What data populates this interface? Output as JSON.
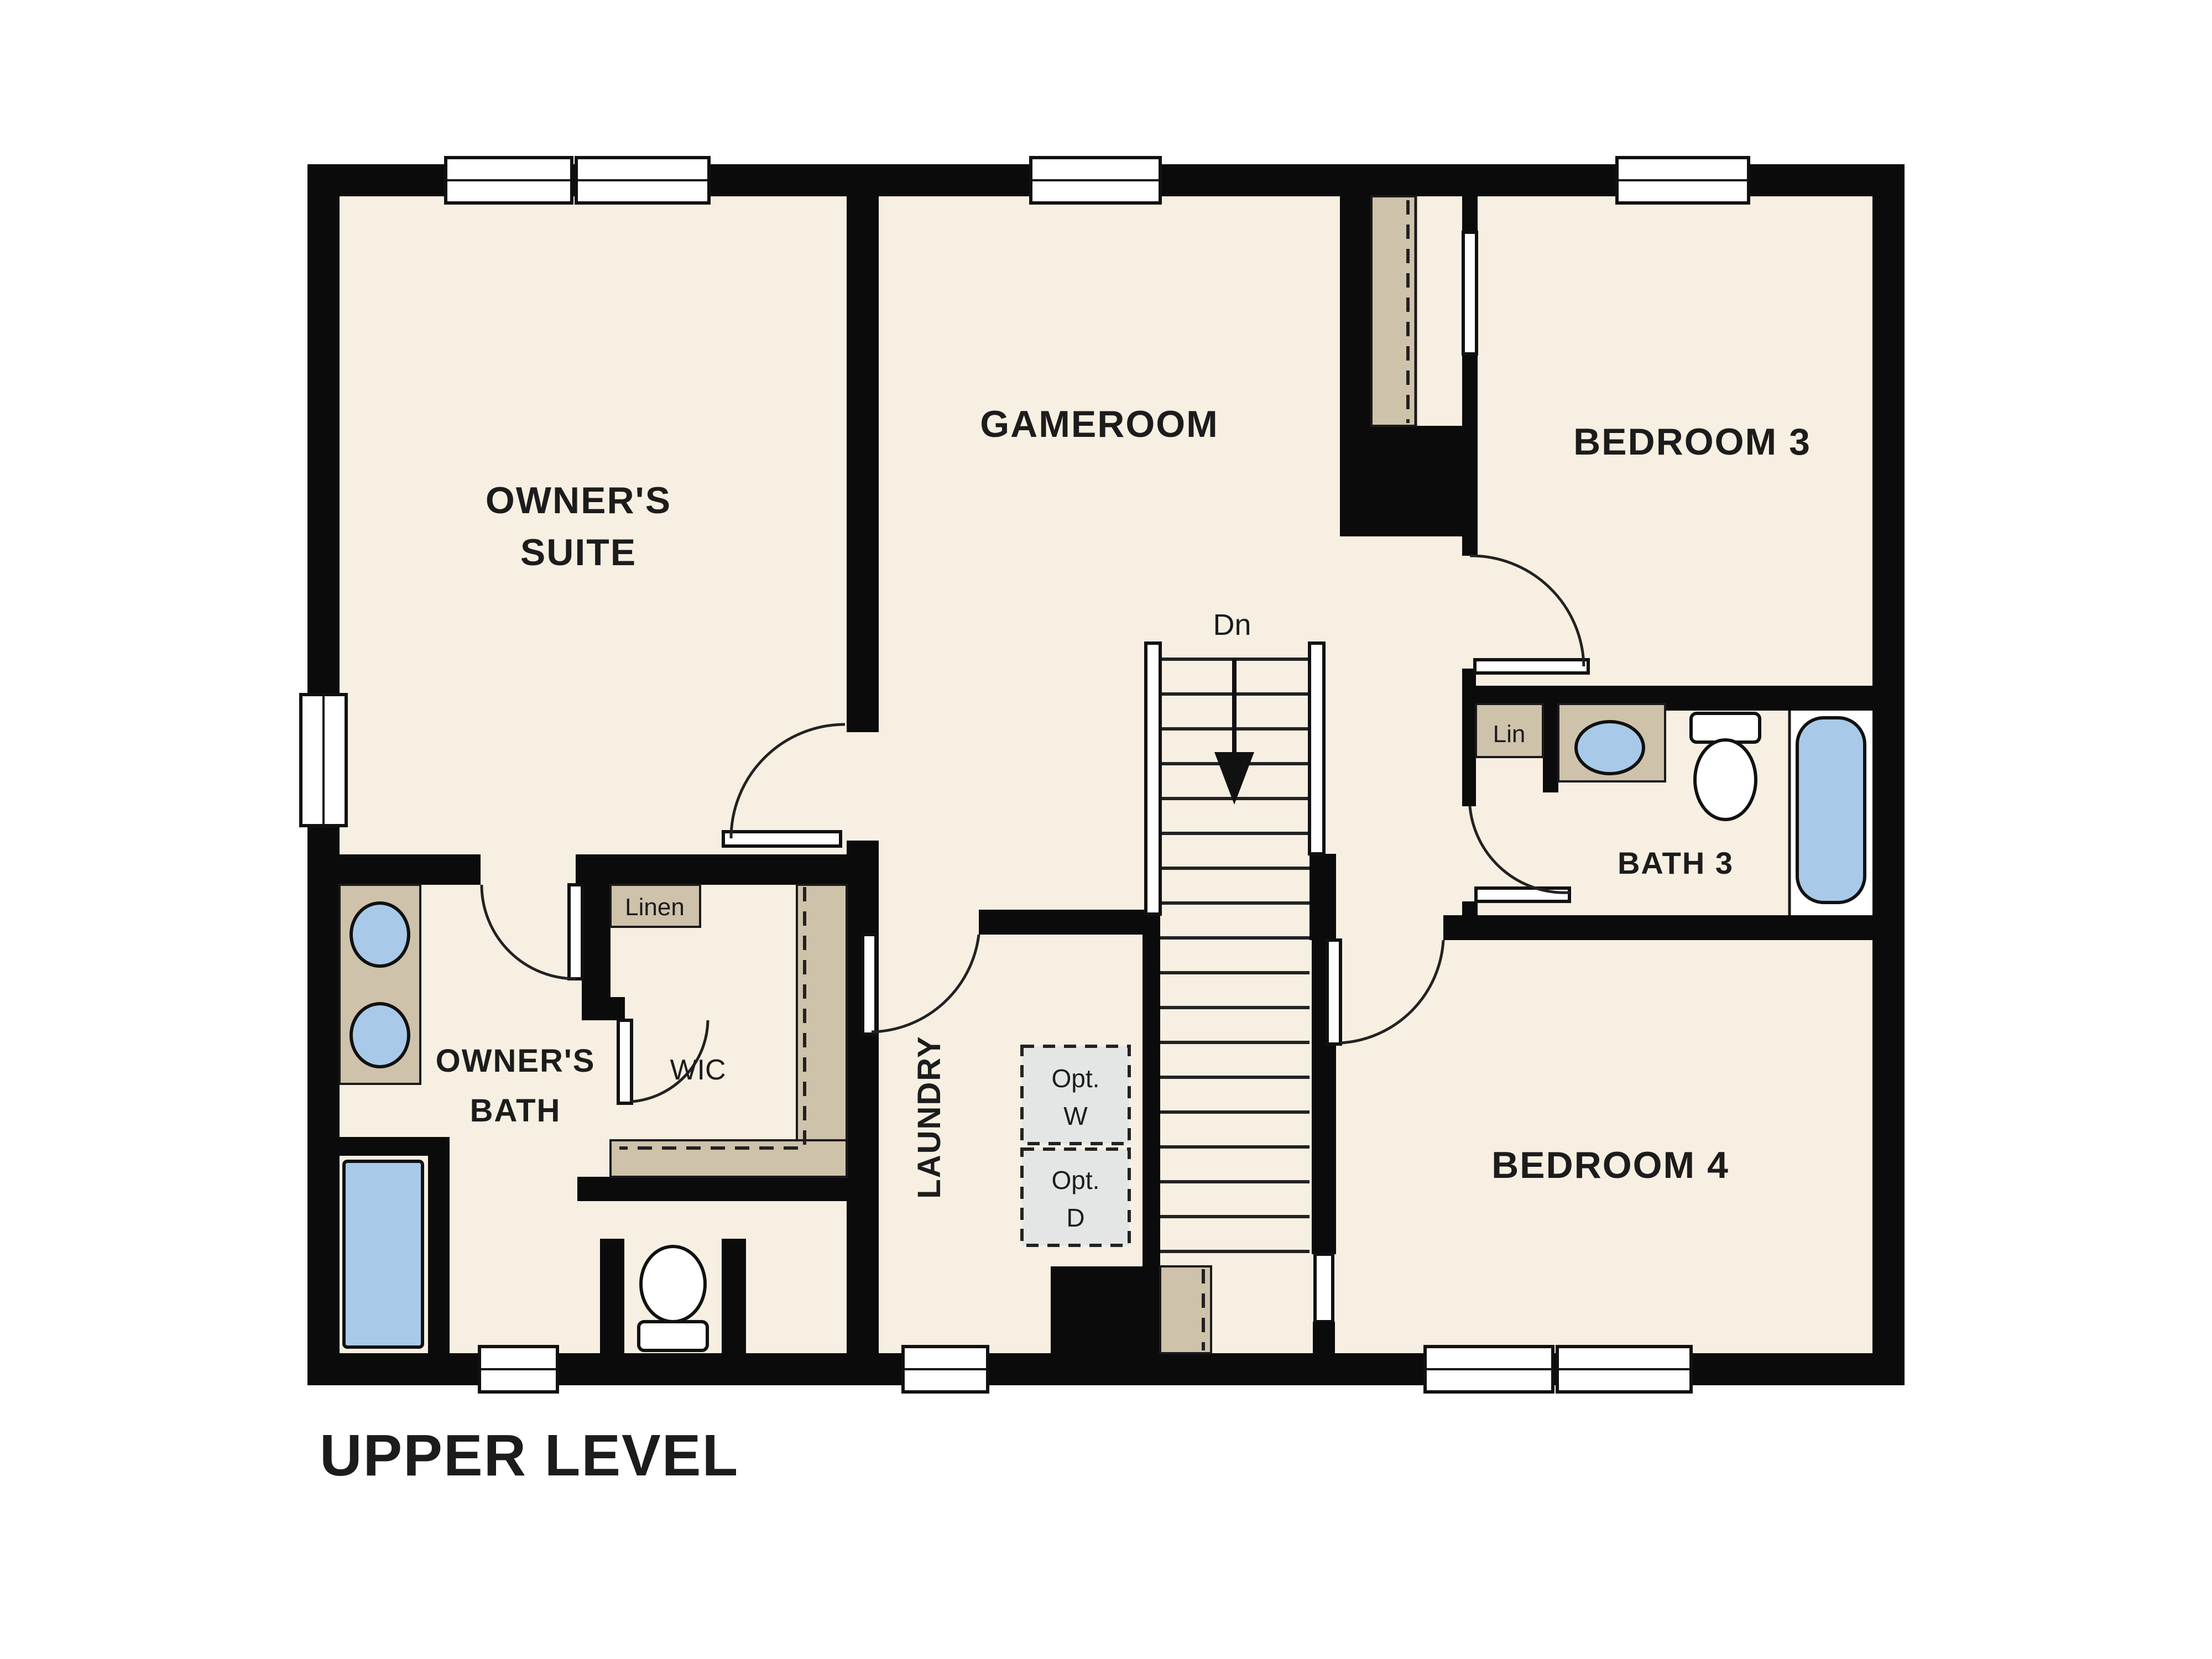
{
  "plan": {
    "level_label": "UPPER LEVEL",
    "rooms": {
      "owners_suite": {
        "line1": "OWNER'S",
        "line2": "SUITE"
      },
      "gameroom": {
        "label": "GAMEROOM"
      },
      "bedroom3": {
        "label": "BEDROOM 3"
      },
      "bath3": {
        "label": "BATH 3"
      },
      "bedroom4": {
        "label": "BEDROOM 4"
      },
      "owners_bath": {
        "line1": "OWNER'S",
        "line2": "BATH"
      },
      "wic": {
        "label": "WIC"
      },
      "laundry": {
        "label": "LAUNDRY"
      }
    },
    "closets": {
      "linen": "Linen",
      "lin": "Lin"
    },
    "stairs": {
      "label": "Dn",
      "direction": "down"
    },
    "appliances": {
      "washer": {
        "line1": "Opt.",
        "line2": "W"
      },
      "dryer": {
        "line1": "Opt.",
        "line2": "D"
      }
    },
    "colors": {
      "floor": "#f6efe2",
      "wall": "#0b0b0b",
      "casework_tan": "#cfc2ab",
      "fixture_blue": "#a9c9e9",
      "optional_gray": "#e3e6e4"
    }
  }
}
